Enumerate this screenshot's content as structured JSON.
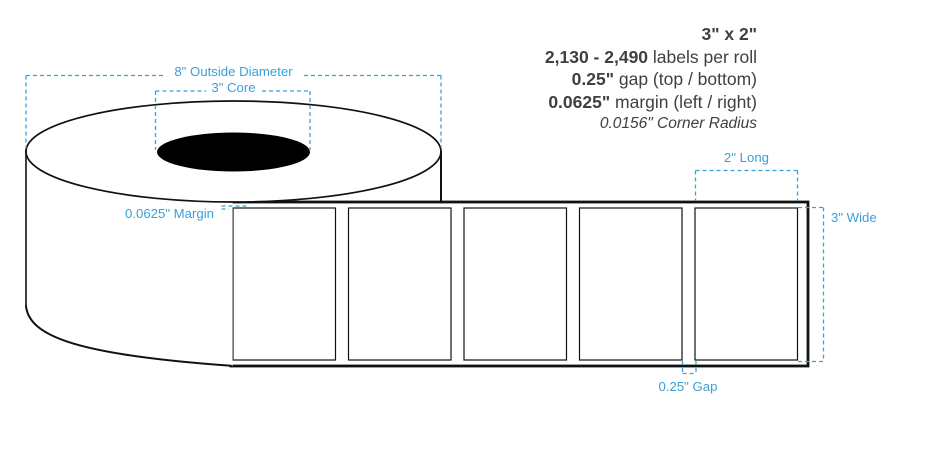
{
  "specs": {
    "size": "3\" x 2\"",
    "labels_per_roll": {
      "value": "2,130 - 2,490",
      "suffix": " labels per roll"
    },
    "gap": {
      "value": "0.25\"",
      "suffix": " gap (top / bottom)"
    },
    "margin": {
      "value": "0.0625\"",
      "suffix": " margin (left / right)"
    },
    "corner_radius": "0.0156\" Corner Radius"
  },
  "diagram": {
    "annotations": {
      "outside_diameter": "8\" Outside Diameter",
      "core": "3\" Core",
      "margin": "0.0625\" Margin",
      "label_length": "2\" Long",
      "roll_width": "3\" Wide",
      "label_gap": "0.25\" Gap"
    },
    "label_count": 5
  },
  "colors": {
    "annotation_blue": "#38a1d7",
    "spec_text": "#404040",
    "diagram_stroke": "#111111"
  }
}
